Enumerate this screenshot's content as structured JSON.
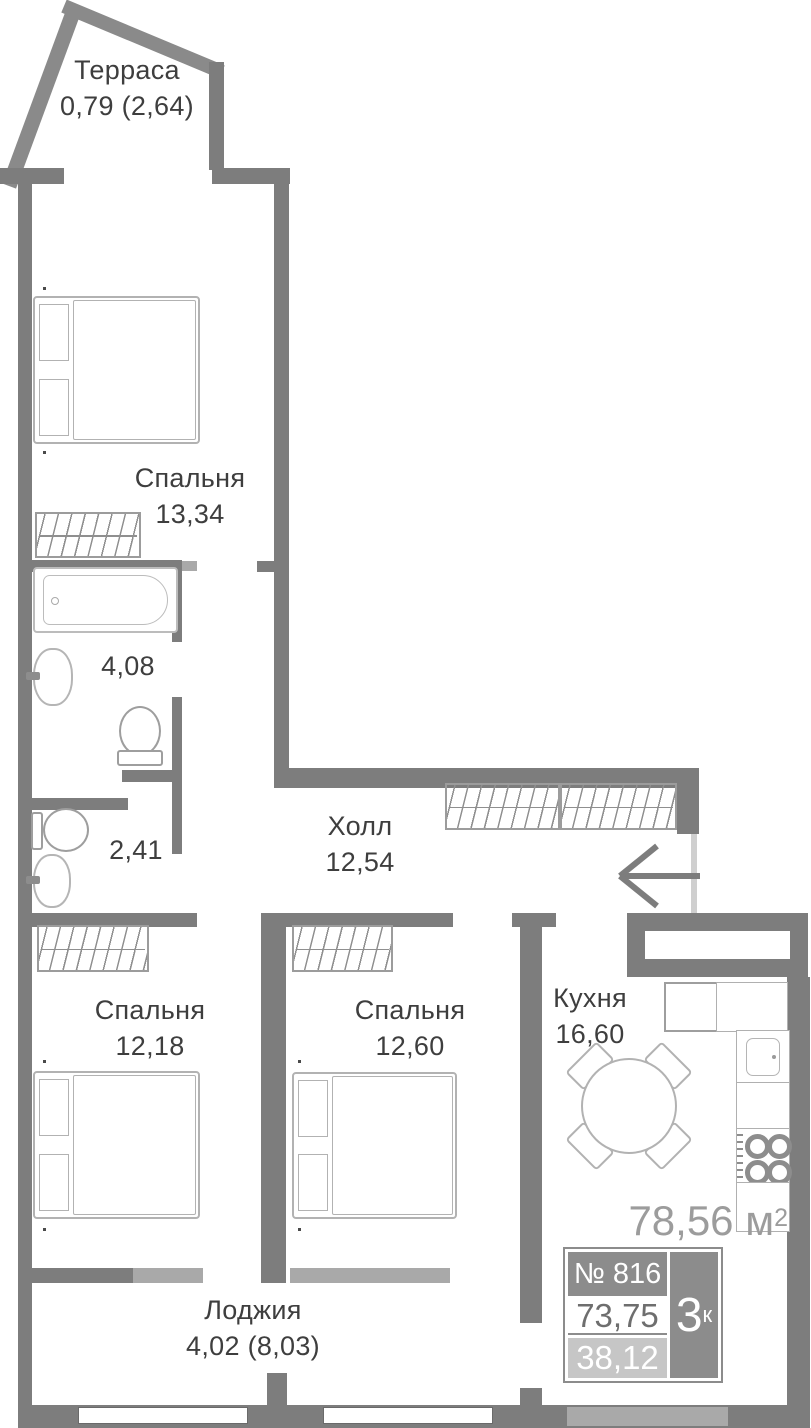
{
  "title": "План квартиры",
  "rooms": {
    "terrace": {
      "name": "Терраса",
      "area": "0,79 (2,64)"
    },
    "bedroom1": {
      "name": "Спальня",
      "area": "13,34"
    },
    "bathroom": {
      "area": "4,08"
    },
    "wc": {
      "area": "2,41"
    },
    "hall": {
      "name": "Холл",
      "area": "12,54"
    },
    "bedroom2": {
      "name": "Спальня",
      "area": "12,18"
    },
    "bedroom3": {
      "name": "Спальня",
      "area": "12,60"
    },
    "kitchen": {
      "name": "Кухня",
      "area": "16,60"
    },
    "loggia": {
      "name": "Лоджия",
      "area": "4,02 (8,03)"
    }
  },
  "summary": {
    "total_area_value": "78,56",
    "total_area_unit": " м",
    "total_area_sup": "2",
    "apartment_number": "№ 816",
    "rooms_count": "3",
    "rooms_count_suffix": "к",
    "area_living": "73,75",
    "area_secondary": "38,12"
  },
  "colors": {
    "wall": "#7d7d7d",
    "window_wall": "#a9a9a9",
    "badge_dark": "#8c8c8c",
    "badge_light": "#c6c6c6",
    "room_text": "#3e3e3e",
    "total_area_text": "#9c9c9c"
  }
}
